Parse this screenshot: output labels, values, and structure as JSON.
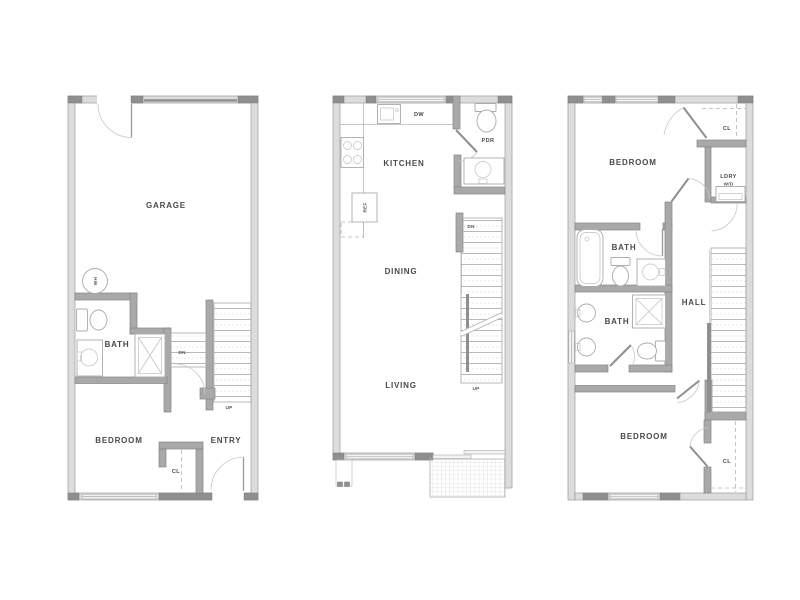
{
  "palette": {
    "background": "#ffffff",
    "exterior_wall": "#dcdcdc",
    "interior_wall": "#a9a9a9",
    "post": "#8f8f8f",
    "fixture_line": "#ababab",
    "door_arc": "#c8c8c8",
    "label_text": "#4a4a4a"
  },
  "floors": [
    {
      "rooms": {
        "garage": "GARAGE",
        "bath": "BATH",
        "bedroom": "BEDROOM",
        "entry": "ENTRY",
        "closet": "CL"
      },
      "marks": {
        "water_heater": "WH",
        "down": "DN",
        "up": "UP"
      }
    },
    {
      "rooms": {
        "kitchen": "KITCHEN",
        "powder_room": "PDR",
        "dining": "DINING",
        "living": "LIVING"
      },
      "marks": {
        "dishwasher": "DW",
        "refrigerator": "REF",
        "down": "DN",
        "up": "UP"
      }
    },
    {
      "rooms": {
        "bedroom_upper": "BEDROOM",
        "closet_upper": "CL",
        "laundry": "LDRY",
        "washer_dryer": "W/D",
        "bath_upper": "BATH",
        "bath_lower": "BATH",
        "hall": "HALL",
        "bedroom_lower": "BEDROOM",
        "closet_lower": "CL"
      }
    }
  ]
}
